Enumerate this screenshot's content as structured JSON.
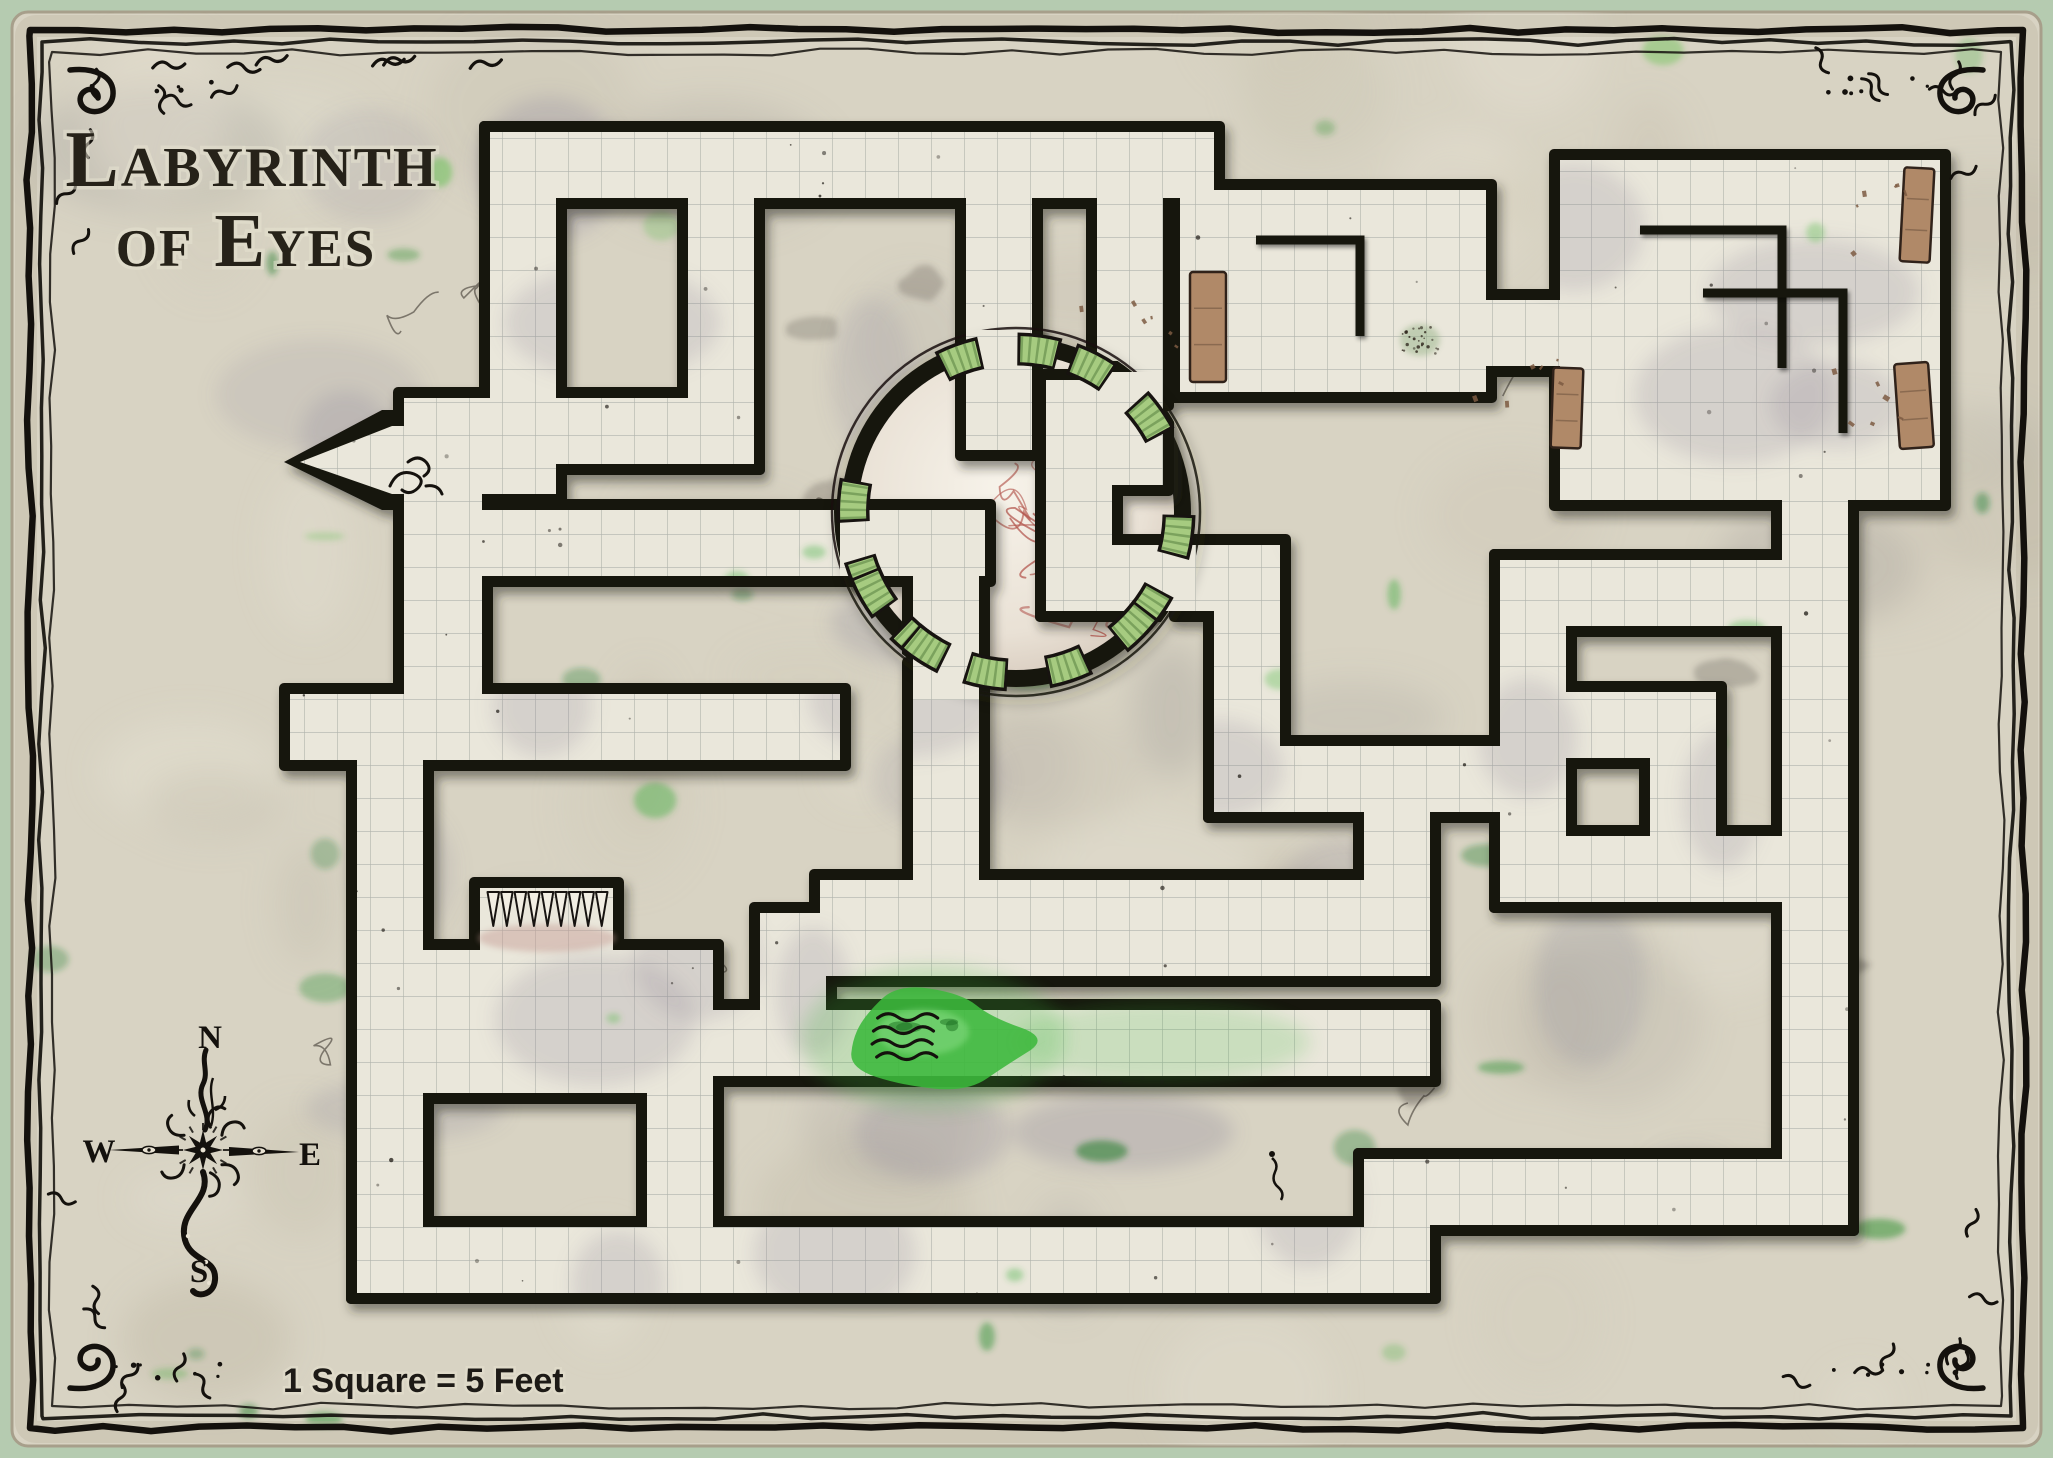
{
  "title": {
    "line1": "Labyrinth",
    "line2": "of Eyes"
  },
  "scale_label": "1 Square = 5 Feet",
  "compass": {
    "n": "N",
    "e": "E",
    "s": "S",
    "w": "W"
  },
  "colors": {
    "page_bg": "#b5cbb0",
    "parchment": "#d8d3c3",
    "floor": "#eae7db",
    "grid_line": "#87908c",
    "wall": "#171310",
    "moss": "#3fae3c",
    "pool": "#3cb83c",
    "vein": "#b2554d",
    "lens": "#a6cb80",
    "lens_dark": "#4f7a39",
    "wood": "#b08968",
    "ink": "#14110d",
    "title_ink": "#262219"
  },
  "map_data": {
    "grid_size": 33,
    "eye_chamber": {
      "cx": 1016,
      "cy": 512,
      "r_outer": 175,
      "r_inner": 158
    },
    "floors_outside": [
      [
        490,
        132,
        556,
        494
      ],
      [
        490,
        132,
        1214,
        198
      ],
      [
        688,
        160,
        754,
        464
      ],
      [
        470,
        398,
        754,
        464
      ],
      [
        404,
        398,
        482,
        760
      ],
      [
        470,
        510,
        856,
        576
      ],
      [
        290,
        694,
        840,
        760
      ],
      [
        357,
        694,
        423,
        1012
      ],
      [
        357,
        950,
        713,
        1093
      ],
      [
        357,
        950,
        423,
        1293
      ],
      [
        357,
        1227,
        713,
        1293
      ],
      [
        647,
        950,
        713,
        1293
      ],
      [
        480,
        888,
        613,
        1027
      ],
      [
        647,
        1010,
        1430,
        1076
      ],
      [
        820,
        880,
        1430,
        976
      ],
      [
        760,
        913,
        826,
        1076
      ],
      [
        647,
        1227,
        1430,
        1293
      ],
      [
        1364,
        1159,
        1430,
        1293
      ],
      [
        1364,
        1159,
        1848,
        1225
      ],
      [
        1782,
        890,
        1848,
        1225
      ],
      [
        1364,
        746,
        1430,
        913
      ],
      [
        1214,
        746,
        1566,
        812
      ],
      [
        1214,
        596,
        1280,
        812
      ],
      [
        1180,
        545,
        1280,
        611
      ],
      [
        1500,
        560,
        1848,
        626
      ],
      [
        1782,
        560,
        1848,
        902
      ],
      [
        1500,
        836,
        1848,
        902
      ],
      [
        1500,
        560,
        1566,
        902
      ],
      [
        1560,
        692,
        1716,
        758
      ],
      [
        1650,
        758,
        1716,
        902
      ],
      [
        1560,
        160,
        1940,
        500
      ],
      [
        1180,
        190,
        1486,
        392
      ],
      [
        1486,
        300,
        1560,
        366
      ],
      [
        1782,
        488,
        1848,
        572
      ],
      [
        1097,
        185,
        1163,
        400
      ],
      [
        966,
        185,
        1032,
        352
      ],
      [
        913,
        668,
        979,
        913
      ]
    ],
    "floors_inside": [
      [
        840,
        510,
        985,
        576
      ],
      [
        966,
        330,
        1032,
        450
      ],
      [
        1097,
        372,
        1163,
        485
      ],
      [
        913,
        530,
        979,
        700
      ],
      [
        1046,
        380,
        1112,
        611
      ],
      [
        1046,
        545,
        1196,
        611
      ]
    ],
    "entry_passage": {
      "outer": [
        [
          284,
          462
        ],
        [
          382,
          410
        ],
        [
          513,
          410
        ],
        [
          513,
          510
        ],
        [
          382,
          510
        ]
      ],
      "inner": [
        [
          300,
          462
        ],
        [
          392,
          426
        ],
        [
          502,
          426
        ],
        [
          502,
          494
        ],
        [
          392,
          494
        ]
      ]
    },
    "lens_angles_deg": [
      -96,
      -49,
      22,
      114,
      170,
      137,
      58
    ],
    "interior_walls": [
      "M1640,230 L1782,230 L1782,368",
      "M1703,293 L1843,293 L1843,433",
      "M1256,240 L1360,240 L1360,336"
    ],
    "furniture": [
      [
        1902,
        168,
        30,
        94,
        3
      ],
      [
        1897,
        363,
        34,
        85,
        -4
      ],
      [
        1190,
        272,
        36,
        110,
        0
      ],
      [
        1552,
        368,
        30,
        80,
        2
      ]
    ],
    "spikes": {
      "x1": 486,
      "x2": 608,
      "y": 892,
      "length": 34,
      "count": 9
    },
    "pool": {
      "cx": 933,
      "cy": 1038,
      "rx": 92,
      "ry": 46
    }
  }
}
